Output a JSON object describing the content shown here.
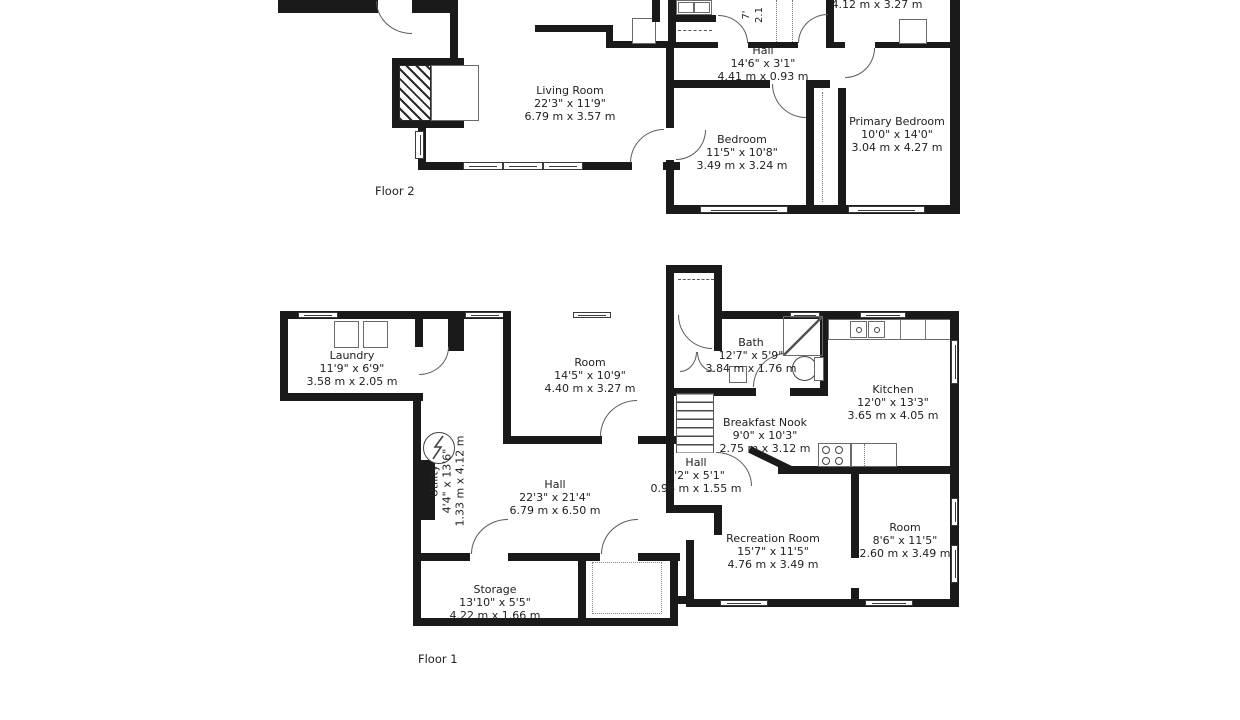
{
  "colors": {
    "wall": "#1a1a1a",
    "text": "#222222",
    "background": "#ffffff"
  },
  "floor2": {
    "label": "Floor 2",
    "rooms": {
      "living_room": {
        "name": "Living Room",
        "dim_ft": "22'3\" x 11'9\"",
        "dim_m": "6.79 m x 3.57 m"
      },
      "hall": {
        "name": "Hall",
        "dim_ft": "14'6\" x 3'1\"",
        "dim_m": "4.41 m x 0.93 m"
      },
      "bedroom": {
        "name": "Bedroom",
        "dim_ft": "11'5\" x 10'8\"",
        "dim_m": "3.49 m x 3.24 m"
      },
      "primary_bedroom": {
        "name": "Primary Bedroom",
        "dim_ft": "10'0\" x 14'0\"",
        "dim_m": "3.04 m x 4.27 m"
      },
      "room_top_right_partial": {
        "dim_m": "4.12 m x 3.27 m"
      },
      "closet_partial": {
        "dim_ft": "7'",
        "dim_m": "2.1"
      }
    }
  },
  "floor1": {
    "label": "Floor 1",
    "rooms": {
      "laundry": {
        "name": "Laundry",
        "dim_ft": "11'9\" x 6'9\"",
        "dim_m": "3.58 m x 2.05 m"
      },
      "room": {
        "name": "Room",
        "dim_ft": "14'5\" x 10'9\"",
        "dim_m": "4.40 m x 3.27 m"
      },
      "bath": {
        "name": "Bath",
        "dim_ft": "12'7\" x 5'9\"",
        "dim_m": "3.84 m x 1.76 m"
      },
      "kitchen": {
        "name": "Kitchen",
        "dim_ft": "12'0\" x 13'3\"",
        "dim_m": "3.65 m x 4.05 m"
      },
      "breakfast_nook": {
        "name": "Breakfast Nook",
        "dim_ft": "9'0\" x 10'3\"",
        "dim_m": "2.75 m x 3.12 m"
      },
      "hall_small": {
        "name": "Hall",
        "dim_ft": "3'2\" x 5'1\"",
        "dim_m": "0.96 m x 1.55 m"
      },
      "hall_large": {
        "name": "Hall",
        "dim_ft": "22'3\" x 21'4\"",
        "dim_m": "6.79 m x 6.50 m"
      },
      "utility": {
        "name": "Utility",
        "dim_ft": "4'4\" x 13'6\"",
        "dim_m": "1.33 m x 4.12 m"
      },
      "recreation_room": {
        "name": "Recreation Room",
        "dim_ft": "15'7\" x 11'5\"",
        "dim_m": "4.76 m x 3.49 m"
      },
      "room_small": {
        "name": "Room",
        "dim_ft": "8'6\" x 11'5\"",
        "dim_m": "2.60 m x 3.49 m"
      },
      "storage": {
        "name": "Storage",
        "dim_ft": "13'10\" x 5'5\"",
        "dim_m": "4.22 m x 1.66 m"
      }
    }
  }
}
